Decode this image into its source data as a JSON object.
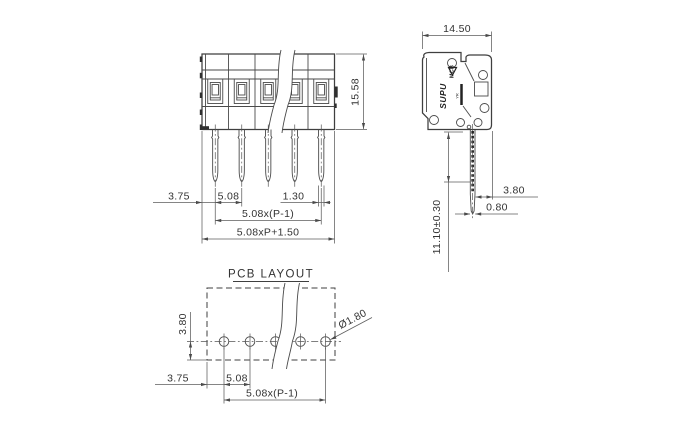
{
  "front": {
    "height": "15.58",
    "edge": "3.75",
    "pitch": "5.08",
    "pin_width": "1.30",
    "span": "5.08x(P-1)",
    "overall": "5.08xP+1.50"
  },
  "side": {
    "width": "14.50",
    "tail_offset": "3.80",
    "tail_thickness": "0.80",
    "tail_length": "11.10±0.30",
    "logo": "SUPU",
    "logo_series": "MCB",
    "logo_mark": "YR"
  },
  "pcb": {
    "title": "PCB LAYOUT",
    "row_offset": "3.80",
    "edge": "3.75",
    "pitch": "5.08",
    "span": "5.08x(P-1)",
    "hole_diameter": "Ø1.80"
  },
  "colors": {
    "line": "#3f3f3f",
    "dim": "#5d5d5d",
    "background": "#ffffff"
  }
}
